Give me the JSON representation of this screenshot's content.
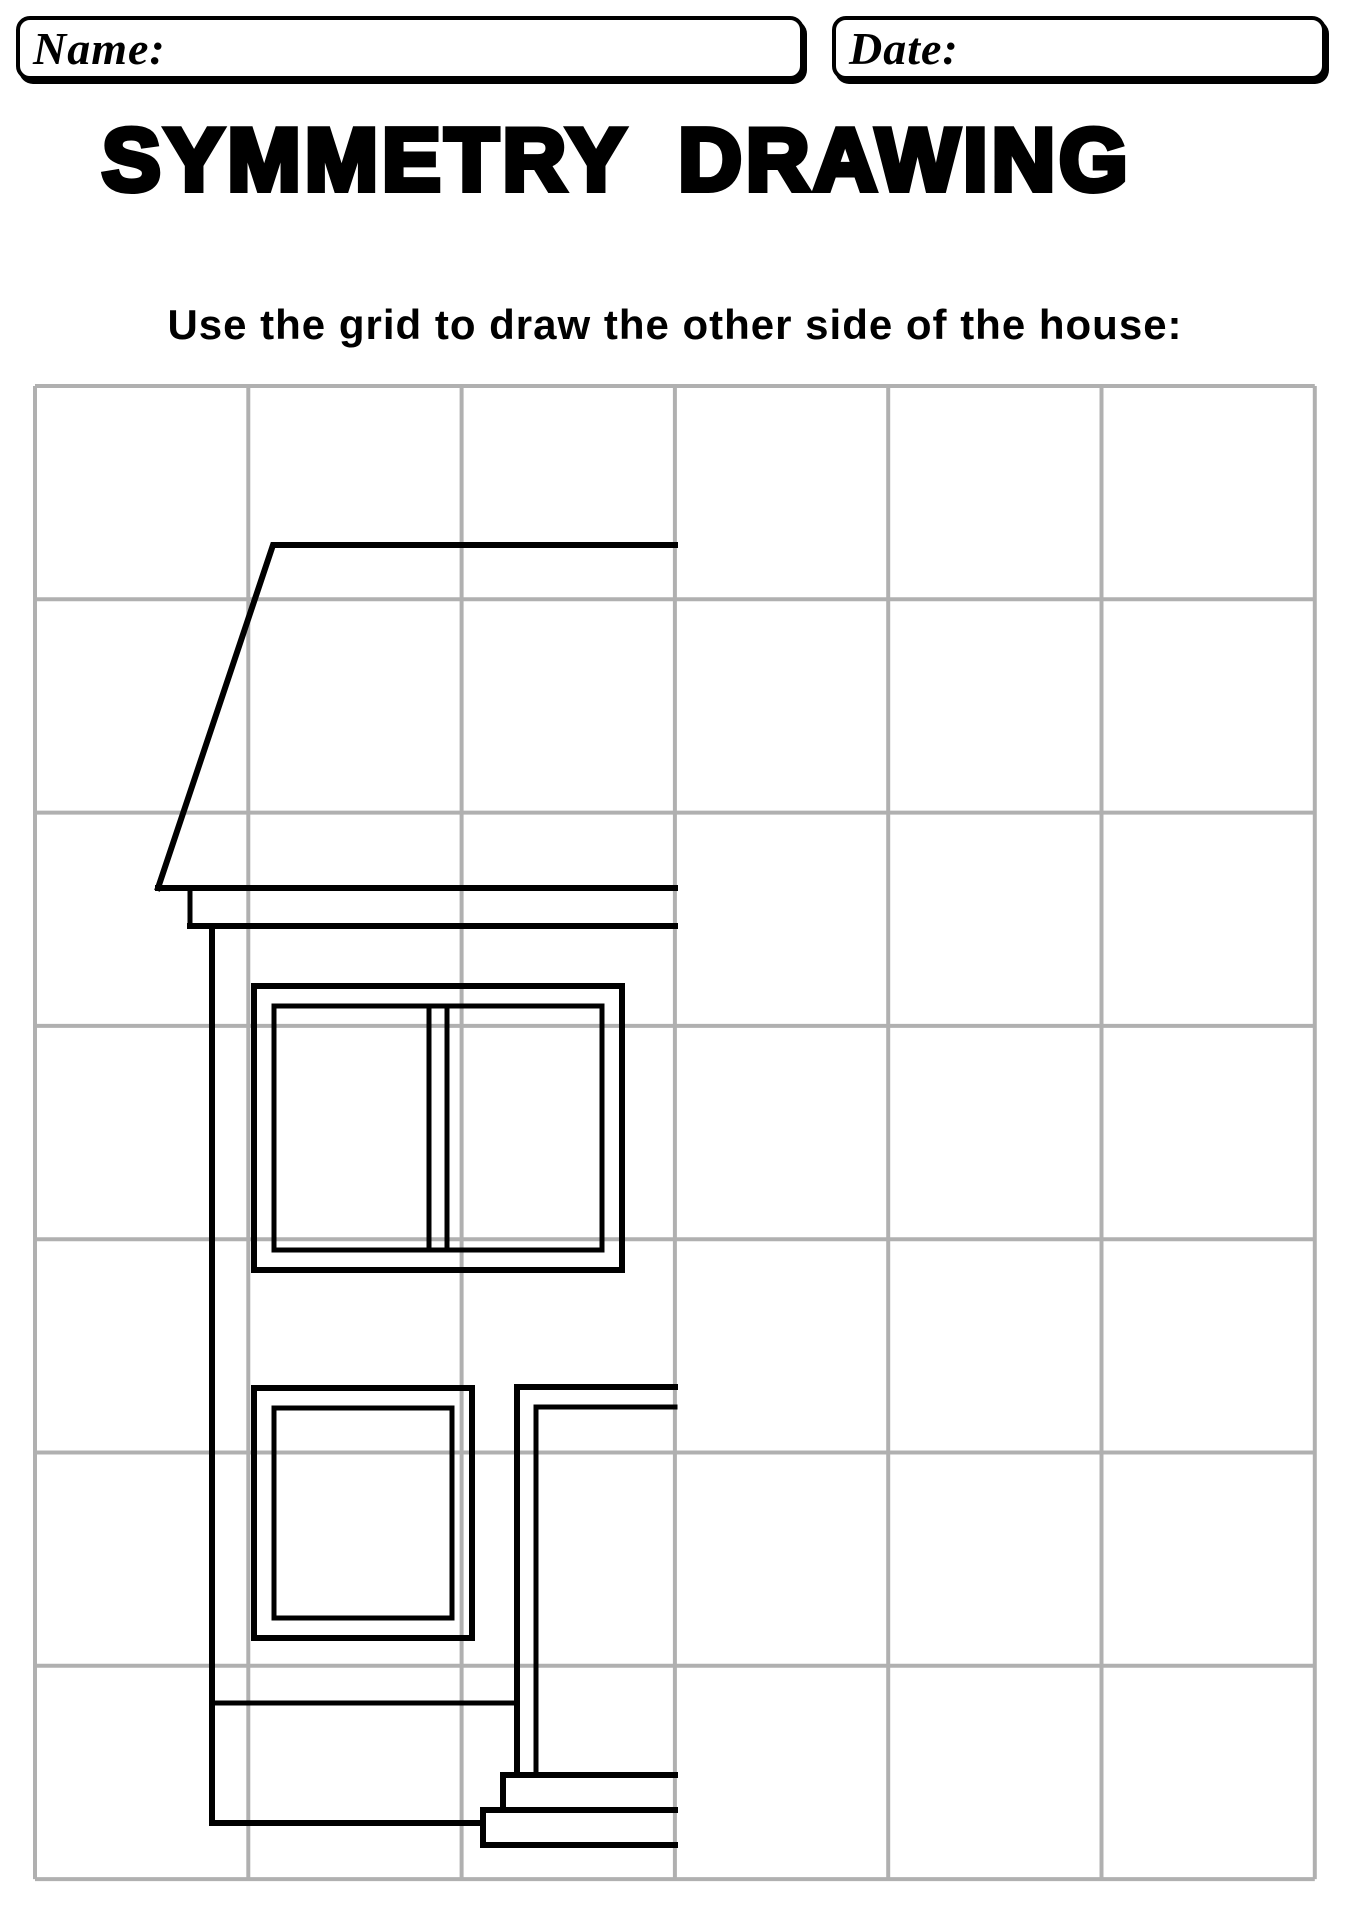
{
  "header": {
    "name_label": "Name:",
    "date_label": "Date:"
  },
  "title": "SYMMETRY DRAWING",
  "instruction": "Use the grid to draw the other side of the house:",
  "colors": {
    "ink": "#000000",
    "grid_line": "#b0b0b0",
    "paper": "#ffffff"
  },
  "grid": {
    "x": 35,
    "y": 386,
    "cols": 6,
    "rows": 7,
    "cell": 213.3,
    "stroke": 4
  },
  "mirror_line_x": 675,
  "house": {
    "stroke_color": "#000000",
    "shapes": [
      {
        "name": "roof-outline",
        "type": "polyline",
        "w": 6,
        "pts": [
          [
            675,
            545
          ],
          [
            273,
            545
          ],
          [
            158,
            888
          ]
        ]
      },
      {
        "name": "roof-eave-top-line",
        "type": "polyline",
        "w": 6,
        "pts": [
          [
            158,
            888
          ],
          [
            675,
            888
          ]
        ]
      },
      {
        "name": "roof-eave-side-line",
        "type": "polyline",
        "w": 5,
        "pts": [
          [
            190,
            890
          ],
          [
            190,
            926
          ]
        ]
      },
      {
        "name": "roof-eave-bottom-line",
        "type": "polyline",
        "w": 6,
        "pts": [
          [
            190,
            926
          ],
          [
            675,
            926
          ]
        ]
      },
      {
        "name": "house-left-wall",
        "type": "polyline",
        "w": 6,
        "pts": [
          [
            212,
            926
          ],
          [
            212,
            1823
          ]
        ]
      },
      {
        "name": "house-floor-line",
        "type": "polyline",
        "w": 5,
        "pts": [
          [
            212,
            1703
          ],
          [
            517,
            1703
          ]
        ]
      },
      {
        "name": "house-bottom-line",
        "type": "polyline",
        "w": 6,
        "pts": [
          [
            212,
            1823
          ],
          [
            483,
            1823
          ]
        ]
      },
      {
        "name": "upper-window-outer-frame",
        "type": "rect",
        "w": 6,
        "x": 254,
        "y": 986,
        "width": 368,
        "height": 284
      },
      {
        "name": "upper-window-inner-frame",
        "type": "rect",
        "w": 5,
        "x": 274,
        "y": 1006,
        "width": 328,
        "height": 244
      },
      {
        "name": "upper-window-mullion-left",
        "type": "polyline",
        "w": 5,
        "pts": [
          [
            429,
            1006
          ],
          [
            429,
            1250
          ]
        ]
      },
      {
        "name": "upper-window-mullion-right",
        "type": "polyline",
        "w": 5,
        "pts": [
          [
            447,
            1006
          ],
          [
            447,
            1250
          ]
        ]
      },
      {
        "name": "lower-window-outer-frame",
        "type": "rect",
        "w": 6,
        "x": 254,
        "y": 1388,
        "width": 218,
        "height": 250
      },
      {
        "name": "lower-window-inner-frame",
        "type": "rect",
        "w": 5,
        "x": 274,
        "y": 1408,
        "width": 178,
        "height": 210
      },
      {
        "name": "door-outer-frame",
        "type": "polyline",
        "w": 6,
        "pts": [
          [
            517,
            1775
          ],
          [
            517,
            1387
          ],
          [
            675,
            1387
          ]
        ]
      },
      {
        "name": "door-inner-frame",
        "type": "polyline",
        "w": 5,
        "pts": [
          [
            536,
            1775
          ],
          [
            536,
            1407
          ],
          [
            675,
            1407
          ]
        ]
      },
      {
        "name": "porch-step-upper",
        "type": "polyline",
        "w": 6,
        "pts": [
          [
            675,
            1775
          ],
          [
            503,
            1775
          ],
          [
            503,
            1810
          ]
        ]
      },
      {
        "name": "porch-step-lower",
        "type": "polyline",
        "w": 6,
        "pts": [
          [
            675,
            1810
          ],
          [
            483,
            1810
          ],
          [
            483,
            1845
          ],
          [
            675,
            1845
          ]
        ]
      }
    ]
  }
}
